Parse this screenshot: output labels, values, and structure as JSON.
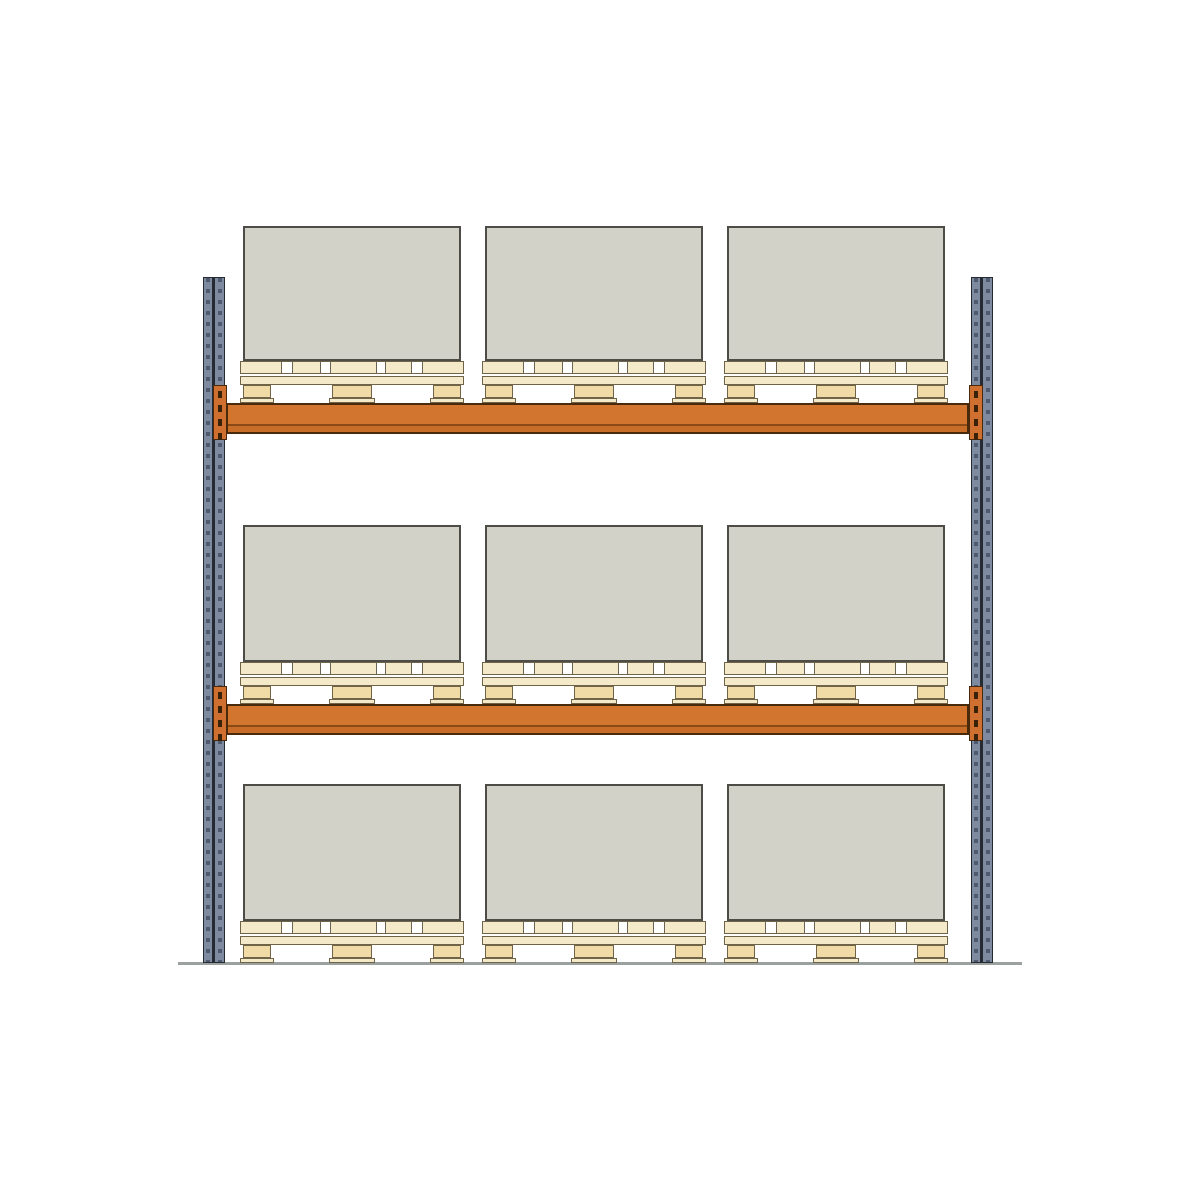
{
  "scene": {
    "name": "pallet-racking-bay-front-view",
    "width": 1200,
    "height": 1200,
    "background": "#ffffff",
    "colors": {
      "box_fill": "#d3d2c8",
      "box_border": "#4e4c47",
      "pallet_wood": "#f4e9c9",
      "pallet_block": "#f0dba6",
      "pallet_outline": "#6f6448",
      "deck_gap_fill": "#ffffff",
      "deck_gap_edge": "#6b6455",
      "beam_fill": "#d2752e",
      "beam_lower_fill": "#c86d28",
      "beam_inner_line": "#8a4a16",
      "beam_border": "#4a2a0c",
      "bracket_fill": "#cf7030",
      "bracket_slot": "#3a2208",
      "upright_fill": "#7e8aa0",
      "upright_frame": "#262b33",
      "upright_holes": "#3d4negative456",
      "upright_hole_tint": "rgba(42,50,68,0.55)",
      "ground": "#9aa19f"
    },
    "ground": {
      "x": 178,
      "y": 962,
      "width": 844,
      "height": 3
    },
    "upright_geom": {
      "y": 277,
      "width": 22,
      "height": 686,
      "strip_w": 8,
      "divider_w": 3,
      "hole_w": 4,
      "hole_h": 4,
      "hole_pitch": 11
    },
    "uprights": [
      {
        "id": "left",
        "x": 203,
        "bracket_side": "right"
      },
      {
        "id": "right",
        "x": 971,
        "bracket_side": "left"
      }
    ],
    "beam_geom": {
      "x": 226,
      "width": 743,
      "height": 31,
      "lower_band_h": 8,
      "bracket_w": 14,
      "bracket_h": 55,
      "bracket_rise": 18,
      "slot_count": 4,
      "slot_w": 4,
      "slot_h": 7
    },
    "beams": [
      {
        "id": "upper",
        "y": 403,
        "bracket_left_x": 213,
        "bracket_right_x": 969
      },
      {
        "id": "lower",
        "y": 704,
        "bracket_left_x": 213,
        "bracket_right_x": 969
      }
    ],
    "levels": [
      {
        "id": "top",
        "box_y": 226,
        "box_h": 135,
        "pallet_y": 361
      },
      {
        "id": "middle",
        "box_y": 525,
        "box_h": 137,
        "pallet_y": 662
      },
      {
        "id": "bottom",
        "box_y": 784,
        "box_h": 137,
        "pallet_y": 921
      }
    ],
    "pallet_x": [
      240,
      482,
      724
    ],
    "pallet_geom": {
      "width": 224,
      "height": 42,
      "deck_h": 13,
      "gap_h": 2,
      "plank_h": 9,
      "block_h": 13,
      "foot_h": 5,
      "deck_gaps": [
        {
          "x": 40,
          "w": 12
        },
        {
          "x": 79,
          "w": 11
        },
        {
          "x": 135,
          "w": 10
        },
        {
          "x": 170,
          "w": 12
        }
      ],
      "blocks": [
        {
          "x": 3,
          "w": 28
        },
        {
          "x": 92,
          "w": 40
        },
        {
          "x": 193,
          "w": 28
        }
      ],
      "feet": [
        {
          "x": 0,
          "w": 34
        },
        {
          "x": 89,
          "w": 46
        },
        {
          "x": 190,
          "w": 34
        }
      ]
    },
    "box_geom": {
      "inset_x": 3,
      "width": 218,
      "border_w": 2
    },
    "counts": {
      "levels": 3,
      "pallets_per_level": 3,
      "boxes_per_level": 3,
      "uprights": 2,
      "beams": 2
    }
  }
}
